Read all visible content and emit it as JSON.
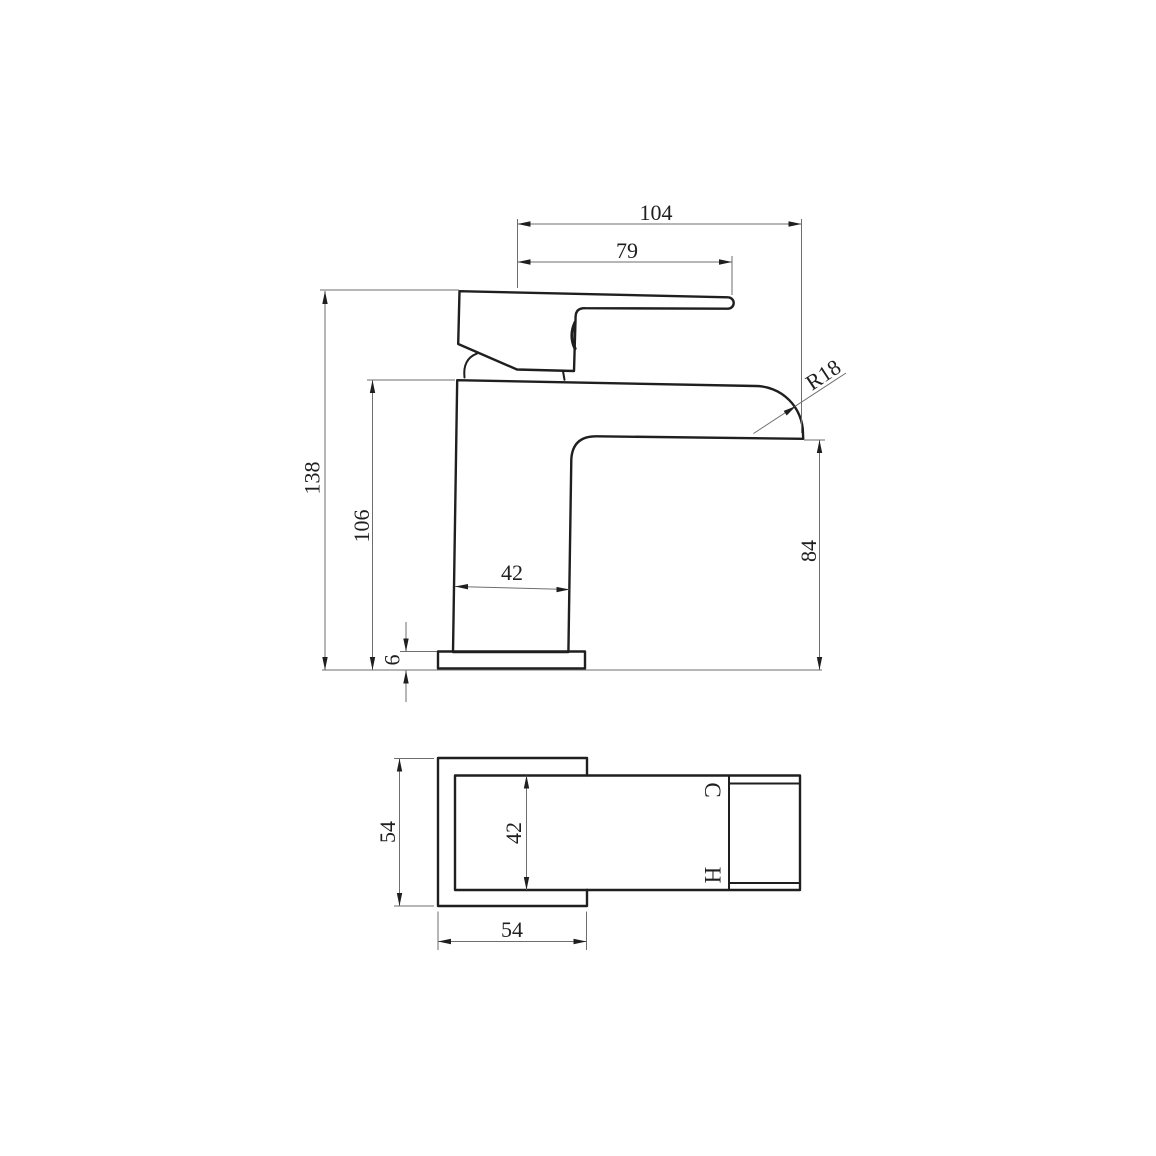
{
  "side_view": {
    "overall_width": "104",
    "handle_width": "79",
    "overall_height": "138",
    "body_height": "106",
    "body_width": "42",
    "base_thickness": "6",
    "spout_outlet_height": "84",
    "spout_radius": "R18"
  },
  "plan_view": {
    "base_depth": "54",
    "body_depth": "42",
    "base_width": "54",
    "cold_indicator": "C",
    "hot_indicator": "H"
  },
  "colors": {
    "outline": "#1f1f1f",
    "dimension_line": "#6e6e6e",
    "text": "#1f1f1f",
    "background": "#ffffff"
  }
}
